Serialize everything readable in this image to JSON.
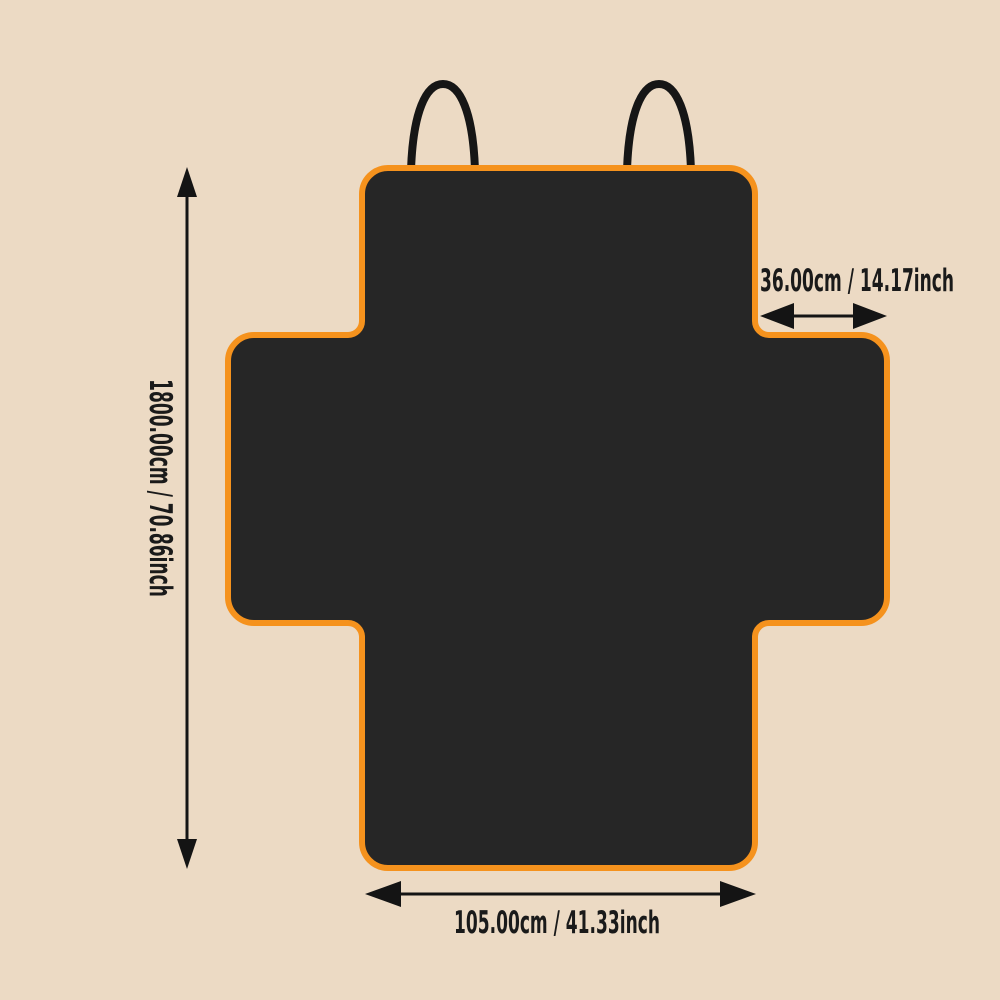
{
  "dimensions": {
    "height_label": "1800.00cm / 70.86inch",
    "flap_width_label": "36.00cm / 14.17inch",
    "bottom_width_label": "105.00cm / 41.33inch"
  },
  "icons": {
    "height_arrow": "double-headed-vertical-arrow",
    "flap_width_arrow": "double-headed-horizontal-arrow",
    "bottom_width_arrow": "double-headed-horizontal-arrow",
    "left_loop": "strap-loop",
    "right_loop": "strap-loop"
  },
  "colors": {
    "background": "#ecdac4",
    "cover_fill": "#262626",
    "trim_orange": "#f5921d",
    "annotation": "#141414"
  }
}
